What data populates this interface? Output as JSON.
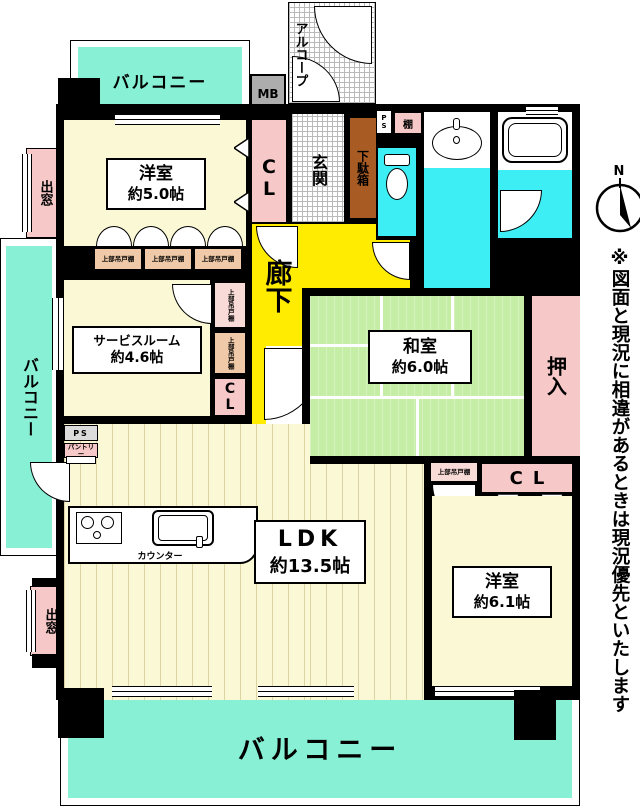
{
  "labels": {
    "balcony": "バルコニー",
    "alcove": "アルコープ",
    "entrance": "玄関",
    "corridor": "廊下",
    "shoe_cabinet": "下駄箱",
    "closet": "CL",
    "oshiire": "押入",
    "meter_box": "MB",
    "pipe_space": "PS",
    "shelf": "棚",
    "pantry": "パントリー",
    "bay_window": "出窓",
    "upper_cupboard": "上部吊戸棚",
    "counter": "カウンター"
  },
  "rooms": {
    "western5": {
      "name": "洋室",
      "size": "約5.0帖"
    },
    "service": {
      "name": "サービスルーム",
      "size": "約4.6帖"
    },
    "japanese": {
      "name": "和室",
      "size": "約6.0帖"
    },
    "ldk": {
      "name": "LDK",
      "size": "約13.5帖"
    },
    "western61": {
      "name": "洋室",
      "size": "約6.1帖"
    }
  },
  "annotations": {
    "compass_n": "N",
    "disclaimer": "※図面と現況に相違があるときは現況優先といたします"
  },
  "colors": {
    "balcony": "#87F0D5",
    "room": "#FBF8D5",
    "corridor": "#FFEC00",
    "tatami": "#C5EDA5",
    "wet_area": "#3DEFF4",
    "closet_pink": "#F7C8C8",
    "cupboard_tan": "#EFC9A8",
    "shoe_cabinet_brown": "#A85B22",
    "meter_box_gray": "#ADADAD",
    "wall": "#000000"
  }
}
